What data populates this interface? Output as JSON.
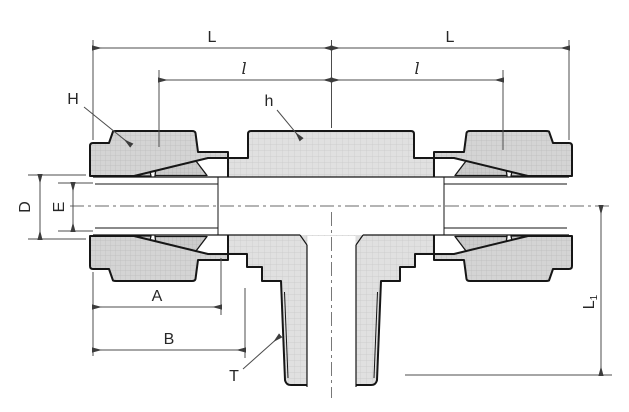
{
  "labels": {
    "dim_L_left": "L",
    "dim_L_right": "L",
    "dim_l_left": "l",
    "dim_l_right": "l",
    "leader_H": "H",
    "leader_h": "h",
    "dim_D": "D",
    "dim_E": "E",
    "dim_A": "A",
    "dim_B": "B",
    "leader_T": "T",
    "dim_L1_main": "L",
    "dim_L1_sub": "1"
  },
  "colors": {
    "background": "#ffffff",
    "outline": "#161616",
    "section_fill": "#e0e0e0",
    "nut_fill": "#d4d4d4",
    "ferrule_fill": "#cccccc",
    "hatch_line": "#c3c3c3",
    "dimension_line": "#4c4c4c",
    "label_text": "#272727"
  }
}
